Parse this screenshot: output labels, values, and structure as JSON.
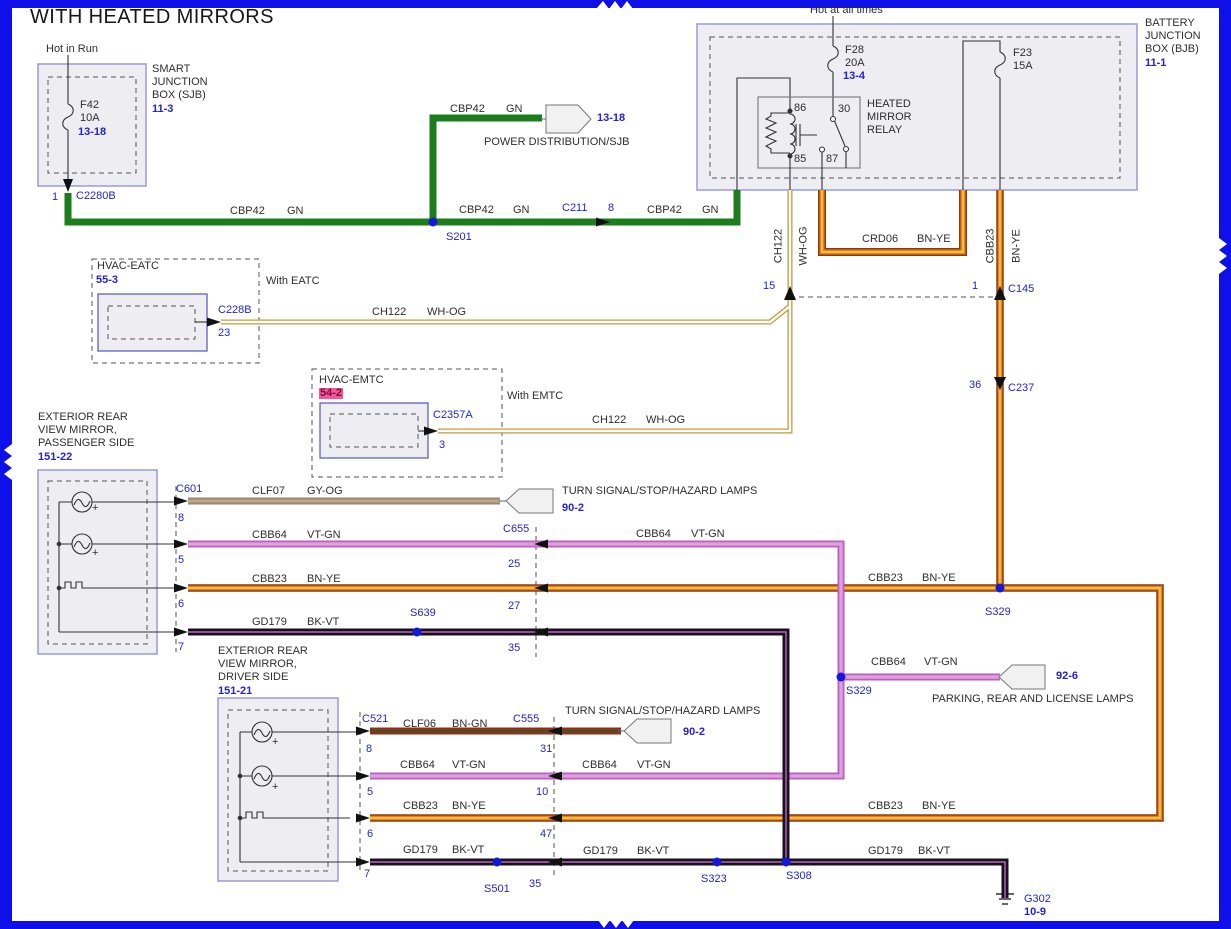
{
  "title": "WITH HEATED MIRRORS",
  "colors": {
    "border_blue": "#0f10e9",
    "box_fill": "#ededf2",
    "box_stroke": "#9a9ade",
    "ref_blue": "#2323d2",
    "splice_blue": "#1518d9",
    "highlight_pink": "#f4559e",
    "wire_green": "#1c7d1c",
    "wire_violet": "#bd5dbd",
    "wire_orange": "#e8821e",
    "wire_brown": "#8a3a10",
    "wire_yellow": "#ffd24d",
    "wire_tan": "#9d8669",
    "wire_black": "#17121d",
    "wire_maroon": "#8d301c",
    "wire_gold": "#c39a3e"
  },
  "sjb": {
    "feed_label": "Hot in Run",
    "fuse_name": "F42",
    "fuse_rating": "10A",
    "fuse_ref": "13-18",
    "box_lines": [
      "SMART",
      "JUNCTION",
      "BOX (SJB)"
    ],
    "page_ref": "11-3",
    "pin": "1",
    "connector": "C2280B"
  },
  "power_dist": {
    "page_ref": "13-18",
    "label": "POWER DISTRIBUTION/SJB"
  },
  "wire_cbp42": {
    "circuit": "CBP42",
    "color_code": "GN"
  },
  "splice_s201": "S201",
  "conn_c211": {
    "name": "C211",
    "pin": "8"
  },
  "bjb": {
    "feed_label": "Hot at all times",
    "fuse28_name": "F28",
    "fuse28_rating": "20A",
    "fuse28_ref": "13-4",
    "fuse23_name": "F23",
    "fuse23_rating": "15A",
    "relay_lines": [
      "HEATED",
      "MIRROR",
      "RELAY"
    ],
    "relay_pin_86": "86",
    "relay_pin_30": "30",
    "relay_pin_85": "85",
    "relay_pin_87": "87",
    "box_lines": [
      "BATTERY",
      "JUNCTION",
      "BOX (BJB)"
    ],
    "page_ref": "11-1"
  },
  "wire_crd06": {
    "circuit": "CRD06",
    "color_code": "BN-YE"
  },
  "wire_ch122": {
    "circuit": "CH122",
    "color_code": "WH-OG"
  },
  "wire_cbb23": {
    "circuit": "CBB23",
    "color_code": "BN-YE"
  },
  "conn_c145": {
    "name": "C145",
    "pin_left": "15",
    "pin_right": "1"
  },
  "conn_c237": {
    "name": "C237",
    "pin": "36"
  },
  "eatc": {
    "title": "HVAC-EATC",
    "page_ref": "55-3",
    "note": "With EATC",
    "connector": "C228B",
    "pin": "23"
  },
  "emtc": {
    "title": "HVAC-EMTC",
    "page_ref": "54-2",
    "note": "With EMTC",
    "connector": "C2357A",
    "pin": "3"
  },
  "mirror_passenger": {
    "title_lines": [
      "EXTERIOR REAR",
      "VIEW MIRROR,",
      "PASSENGER SIDE"
    ],
    "page_ref": "151-22",
    "connector": "C601",
    "pin_1": "8",
    "pin_2": "5",
    "pin_3": "6",
    "pin_4": "7",
    "plus": "+"
  },
  "wire_clf07": {
    "circuit": "CLF07",
    "color_code": "GY-OG"
  },
  "wire_cbb64": {
    "circuit": "CBB64",
    "color_code": "VT-GN"
  },
  "wire_gd179": {
    "circuit": "GD179",
    "color_code": "BK-VT"
  },
  "conn_c655": {
    "name": "C655",
    "pin_1": "25",
    "pin_2": "27",
    "pin_3": "35"
  },
  "splice_s639": "S639",
  "turn_lamps": {
    "label": "TURN SIGNAL/STOP/HAZARD LAMPS",
    "page_ref": "90-2"
  },
  "parking_lamps": {
    "label": "PARKING, REAR AND LICENSE LAMPS",
    "page_ref": "92-6"
  },
  "splice_s329_bnye": "S329",
  "splice_s329_vtgn": "S329",
  "mirror_driver": {
    "title_lines": [
      "EXTERIOR REAR",
      "VIEW MIRROR,",
      "DRIVER SIDE"
    ],
    "page_ref": "151-21",
    "connector": "C521",
    "pin_1": "8",
    "pin_2": "5",
    "pin_3": "6",
    "pin_4": "7",
    "plus": "+"
  },
  "wire_clf06": {
    "circuit": "CLF06",
    "color_code": "BN-GN"
  },
  "conn_c555": {
    "name": "C555",
    "pin_1": "31",
    "pin_2": "10",
    "pin_3": "47",
    "pin_4": "35"
  },
  "splice_s501": "S501",
  "splice_s323": "S323",
  "splice_s308": "S308",
  "ground": {
    "name": "G302",
    "page_ref": "10-9"
  }
}
